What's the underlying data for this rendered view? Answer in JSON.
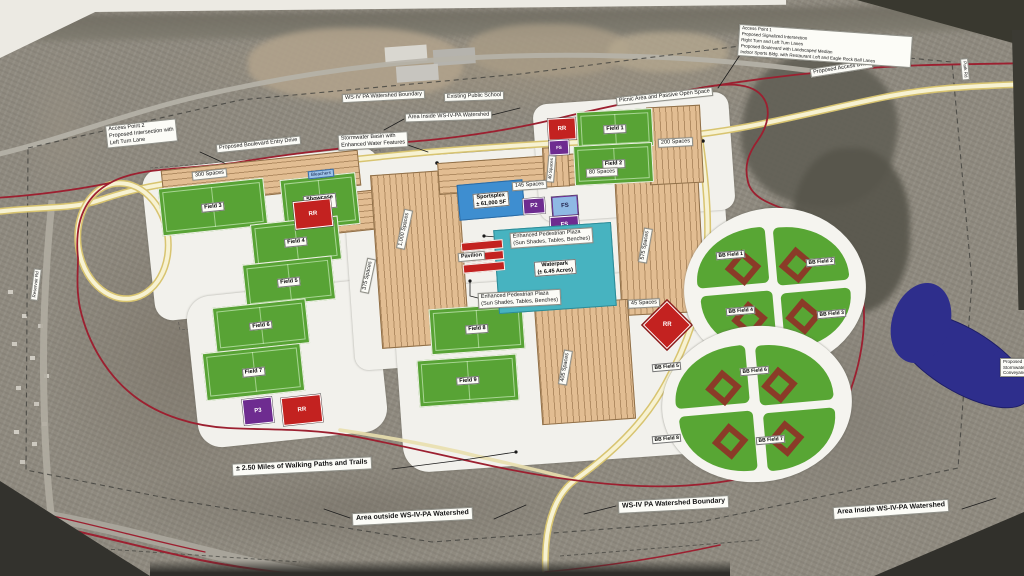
{
  "legend": {
    "lines": [
      "Access Point 1",
      "Proposed Signalized Intersection",
      "Right Turn and Left Turn Lanes",
      "Proposed Boulevard with Landscaped Median",
      "Indoor Sports Bldg. with Restaurant Loft and Eagle Rock Ball Lanes"
    ]
  },
  "notes": {
    "ap2": [
      "Access Point 2",
      "Proposed Intersection with",
      "Left Turn Lane"
    ],
    "boulevard": "Proposed Boulevard Entry Drive",
    "ws_top": "WS-IV PA Watershed Boundary",
    "school": "Existing Public School",
    "inside_top": "Area Inside WS-IV-PA Watershed",
    "storm": [
      "Stormwater Basin with",
      "Enhanced Water Features"
    ],
    "picnic": "Picnic Area and Passive Open Space",
    "access_drive": "Proposed Access Drive",
    "plaza": [
      "Enhanced Pedestrian Plaza",
      "(Sun Shades, Tables, Benches)"
    ],
    "walking": "± 2.50 Miles of Walking Paths and Trails",
    "outside_bottom": "Area outside WS-IV-PA Watershed",
    "ws_bottom": "WS-IV PA Watershed Boundary",
    "inside_bottom": "Area Inside WS-IV-PA Watershed",
    "edge_right": [
      "Proposed",
      "Stormwater",
      "Conveyance"
    ],
    "road_left": "Reservoir Rd",
    "road_right": "Park Rd"
  },
  "fields": {
    "f1": "Field 1",
    "f2": "Field 2",
    "f3": "Field 3",
    "f4": "Field 4",
    "f5": "Field 5",
    "f6": "Field 6",
    "f7": "Field 7",
    "f8": "Field 8",
    "f9": "Field 9",
    "showcase": [
      "Showcase",
      "Field"
    ],
    "bleachers": "Bleachers"
  },
  "bb_fields": [
    "BB Field 1",
    "BB Field 2",
    "BB Field 3",
    "BB Field 4",
    "BB Field 5",
    "BB Field 6",
    "BB Field 7",
    "BB Field 8"
  ],
  "parking": {
    "p300": "300 Spaces",
    "p145": "145 Spaces",
    "p1000": "1,000 Spaces",
    "p375": "375 Spaces",
    "p575": "575 Spaces",
    "p405": "405 Spaces",
    "p200": "200 Spaces",
    "p80": "80 Spaces",
    "p45": "45 Spaces",
    "p40": "40 Spaces"
  },
  "amenities": {
    "sportsplex": [
      "Sportsplex",
      "± 61,000 SF"
    ],
    "waterpark": [
      "Waterpark",
      "(± 6.45 Acres)"
    ],
    "pavilion": "Pavilion"
  },
  "markers": {
    "rr": "RR",
    "p2": "P2",
    "p3": "P3",
    "fs": "FS"
  },
  "colors": {
    "field_green": "#58a335",
    "parking_tan": "#e2bd92",
    "waterpark_teal": "#47b3c0",
    "sportsplex_blue": "#3e8ed0",
    "restroom_red": "#c32220",
    "pavilion_purple": "#6e2c90",
    "boundary_red": "#9c2030",
    "pond_blue": "#2e2e8c",
    "site_white": "#f2f1ec"
  }
}
